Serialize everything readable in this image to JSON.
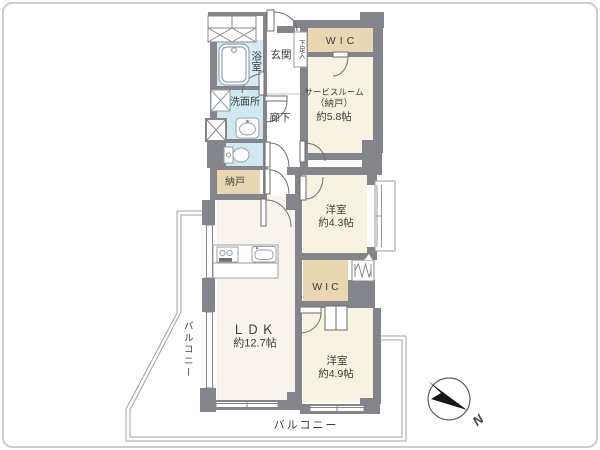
{
  "plan_title": "マンション間取り図",
  "rooms": {
    "bath": {
      "label": "浴室"
    },
    "washroom": {
      "label": "洗面所"
    },
    "entrance": {
      "label": "玄関"
    },
    "shoe_cabinet": {
      "label": "下足入"
    },
    "hallway": {
      "label": "廊下"
    },
    "storage_nando": {
      "label": "納戸"
    },
    "wic_top": {
      "label": "WIC"
    },
    "service_room": {
      "line1": "サービスルーム",
      "line2": "（納戸）",
      "line3": "約5.8帖"
    },
    "bedroom_4_3": {
      "line1": "洋室",
      "line2": "約4.3帖"
    },
    "wic_middle": {
      "label": "WIC"
    },
    "bedroom_4_9": {
      "line1": "洋室",
      "line2": "約4.9帖"
    },
    "ldk": {
      "line1": "ＬＤＫ",
      "line2": "約12.7帖"
    }
  },
  "balconies": {
    "left": {
      "label": "バルコニー"
    },
    "bottom": {
      "label": "バルコニー"
    }
  },
  "compass": {
    "north_label": "N"
  },
  "colors": {
    "wall": "#84858a",
    "wet_area": "#cfe9f0",
    "closet_beige": "#e9d7b4",
    "room_cream": "#f7f3e0",
    "ldk_floor": "#f9f3ed",
    "outline": "#a3a3a3"
  }
}
